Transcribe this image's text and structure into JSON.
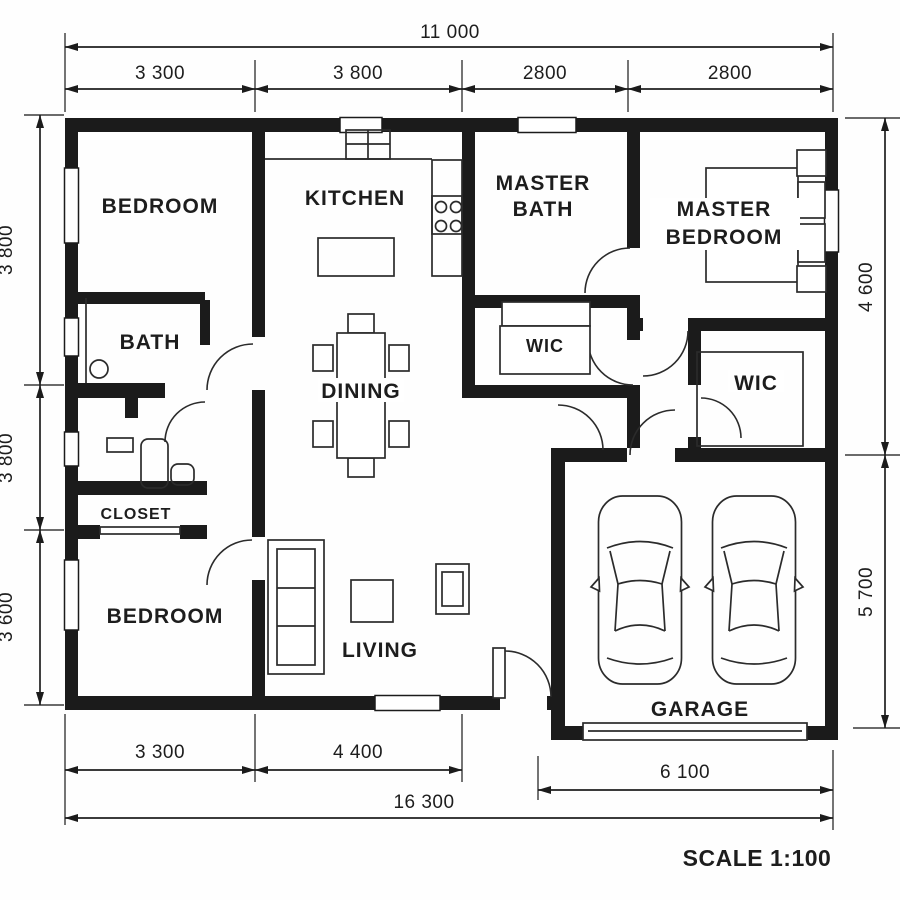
{
  "plan": {
    "scale_label": "SCALE 1:100",
    "rooms": {
      "bedroom_top": "BEDROOM",
      "kitchen": "KITCHEN",
      "master_bath_line1": "MASTER",
      "master_bath_line2": "BATH",
      "master_bedroom_line1": "MASTER",
      "master_bedroom_line2": "BEDROOM",
      "bath": "BATH",
      "wic_master": "WIC",
      "dining": "DINING",
      "wic_right": "WIC",
      "closet": "CLOSET",
      "bedroom_bottom": "BEDROOM",
      "living": "LIVING",
      "garage": "GARAGE"
    },
    "dimensions": {
      "top_total": "11 000",
      "top_segments": [
        "3 300",
        "3 800",
        "2800",
        "2800"
      ],
      "left_segments": [
        "3 800",
        "3 800",
        "3 600"
      ],
      "right_segments": [
        "4 600",
        "5 700"
      ],
      "bottom_segments": [
        "3 300",
        "4 400"
      ],
      "garage_width": "6 100",
      "bottom_total": "16 300"
    }
  }
}
